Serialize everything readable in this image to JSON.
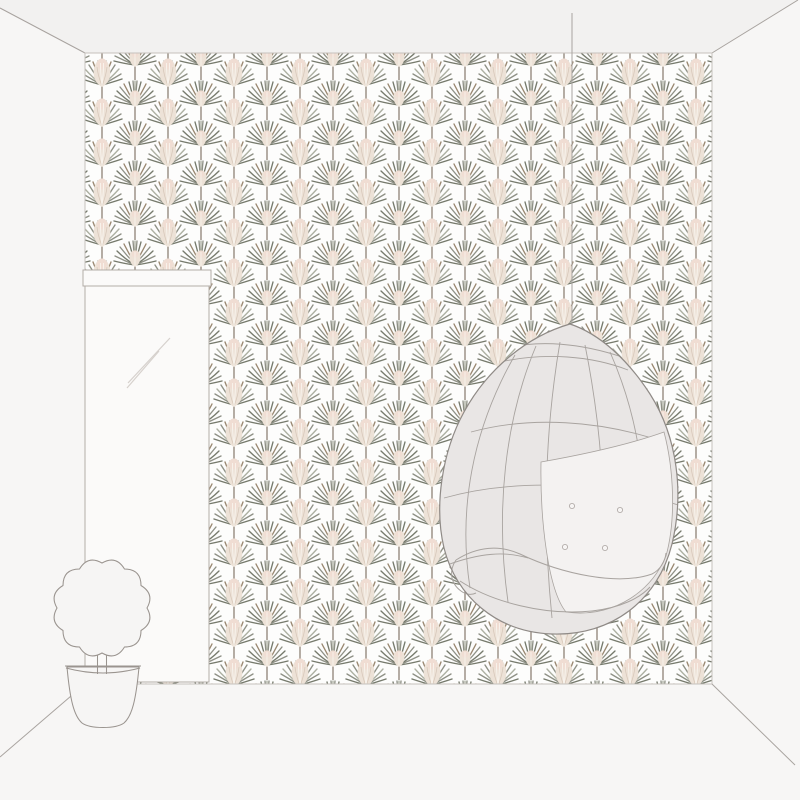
{
  "scene": {
    "type": "interior room wallpaper product mockup illustration",
    "text_content": [],
    "objects": [
      {
        "name": "patterned-wallpaper-wall",
        "description": "back wall covered with fan-palm / pampas-plume wallpaper",
        "pattern": {
          "motifs": [
            "grey fan palm frond burst",
            "cream-blush pampas plume fan"
          ],
          "layout": "half-drop alternating diagonal grid",
          "column_spacing_px": 33,
          "row_spacing_px": 40,
          "background": "white"
        }
      },
      {
        "name": "leaning-mirror",
        "description": "tall rectangular floor mirror with top frame bar and two diagonal reflection lines",
        "position": "left"
      },
      {
        "name": "hanging-egg-chair",
        "description": "egg-shaped hanging chair with woven lattice lines, front opening and tufted cushion, suspended by a cord from the ceiling",
        "position": "right",
        "cushion_buttons": 4
      },
      {
        "name": "potted-topiary-plant",
        "description": "outline drawing of a round scalloped topiary on a trunk in a tapered flower pot",
        "position": "bottom-left"
      },
      {
        "name": "room-shell",
        "description": "ceiling strip with perspective corner diagonals, plain side walls and floor corner lines"
      }
    ]
  },
  "palette": {
    "wall": "#f7f6f5",
    "ceiling": "#f2f1f0",
    "wallpaper_bg": "#fdfdfc",
    "wallpaper_edge": "#c6c1bd",
    "line": "#a8a39f",
    "outline": "#8f8a86",
    "frond_grey": "#8f9186",
    "frond_grey_dark": "#767a6c",
    "frond_grey_light": "#adb0a2",
    "frond_olive": "#98927f",
    "frond_brown": "#9a8871",
    "plume_cream": "#ede2d7",
    "plume_blush": "#f1dcd3",
    "plume_edge": "#d8c8ba",
    "plume_highlight": "#faf6f0",
    "stem": "#8e8276",
    "chair_shell": "#e9e6e5",
    "chair_open": "#f4f2f1",
    "mirror_glass": "#fbfaf9",
    "reflection": "#d6d1cd",
    "pot_fill": "#f6f5f4",
    "plant_line": "#9a948f"
  }
}
